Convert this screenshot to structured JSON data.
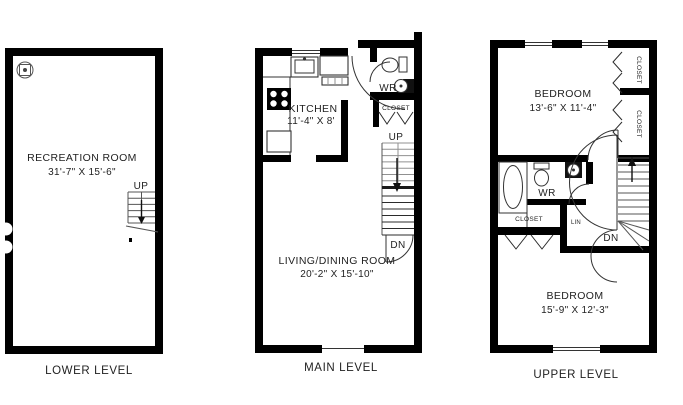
{
  "colors": {
    "wall": "#000000",
    "line": "#333333",
    "text": "#1f1f1f",
    "background": "#ffffff"
  },
  "levels": {
    "lower": {
      "label": "LOWER LEVEL",
      "stairs_up_label": "UP",
      "rooms": {
        "recreation": {
          "name": "RECREATION ROOM",
          "dims": "31'-7\" X 15'-6\""
        }
      }
    },
    "main": {
      "label": "MAIN LEVEL",
      "stairs_up_label": "UP",
      "stairs_down_label": "DN",
      "rooms": {
        "kitchen": {
          "name": "KITCHEN",
          "dims": "11'-4\" X 8'"
        },
        "living": {
          "name": "LIVING/DINING ROOM",
          "dims": "20'-2\" X 15'-10\""
        },
        "wr": {
          "name": "WR"
        },
        "closet": {
          "name": "CLOSET"
        }
      }
    },
    "upper": {
      "label": "UPPER LEVEL",
      "stairs_down_label": "DN",
      "rooms": {
        "bedroom1": {
          "name": "BEDROOM",
          "dims": "13'-6\" X 11'-4\""
        },
        "bedroom2": {
          "name": "BEDROOM",
          "dims": "15'-9\" X 12'-3\""
        },
        "wr": {
          "name": "WR"
        },
        "closet1": {
          "name": "CLOSET"
        },
        "closet2": {
          "name": "CLOSET"
        },
        "closet3": {
          "name": "CLOSET"
        },
        "lin": {
          "name": "LIN"
        }
      }
    }
  }
}
